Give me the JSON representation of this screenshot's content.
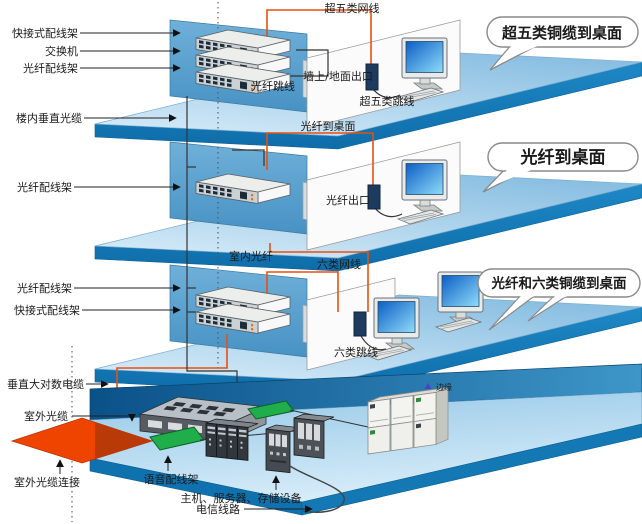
{
  "diagram_title": "structured-cabling-building-diagram",
  "labels": {
    "f1_quick_panel": "快接式配线架",
    "f1_switch": "交换机",
    "f1_fiber_panel": "光纤配线架",
    "riser_fiber": "楼内垂直光缆",
    "f1_cable": "超五类网线",
    "f1_outlet": "墙上/地面出口",
    "f1_patch": "超五类跳线",
    "f1_jumper": "光纤跳线",
    "f1_bubble": "超五类铜缆到桌面",
    "f2_fiber_panel": "光纤配线架",
    "f2_cable": "光纤到桌面",
    "f2_outlet": "光纤出口",
    "f2_bubble": "光纤到桌面",
    "f3_indoor_fiber": "室内光纤",
    "f3_fiber_panel": "光纤配线架",
    "f3_quick_panel": "快接式配线架",
    "f3_cable": "六类网线",
    "f3_patch": "六类跳线",
    "f3_bubble": "光纤和六类铜缆到桌面",
    "b_riser_copper": "垂直大对数电缆",
    "b_outdoor_fiber": "室外光缆",
    "b_outdoor_conn": "室外光缆连接",
    "b_voice_panel": "语音配线架",
    "b_servers": "主机、服务器、存储设备",
    "b_telecom": "电信线路",
    "watermark": "边缘"
  },
  "colors": {
    "cable_orange": "#e8500f",
    "floor_edge_blue": "#1478b6",
    "wall_blue": "#4f9ecd",
    "room_wall_blue": "#0a5188",
    "diamond_orange": "#ee4400",
    "voice_panel_green": "#1fae4a",
    "screen_blue": "#0b5ec6"
  }
}
